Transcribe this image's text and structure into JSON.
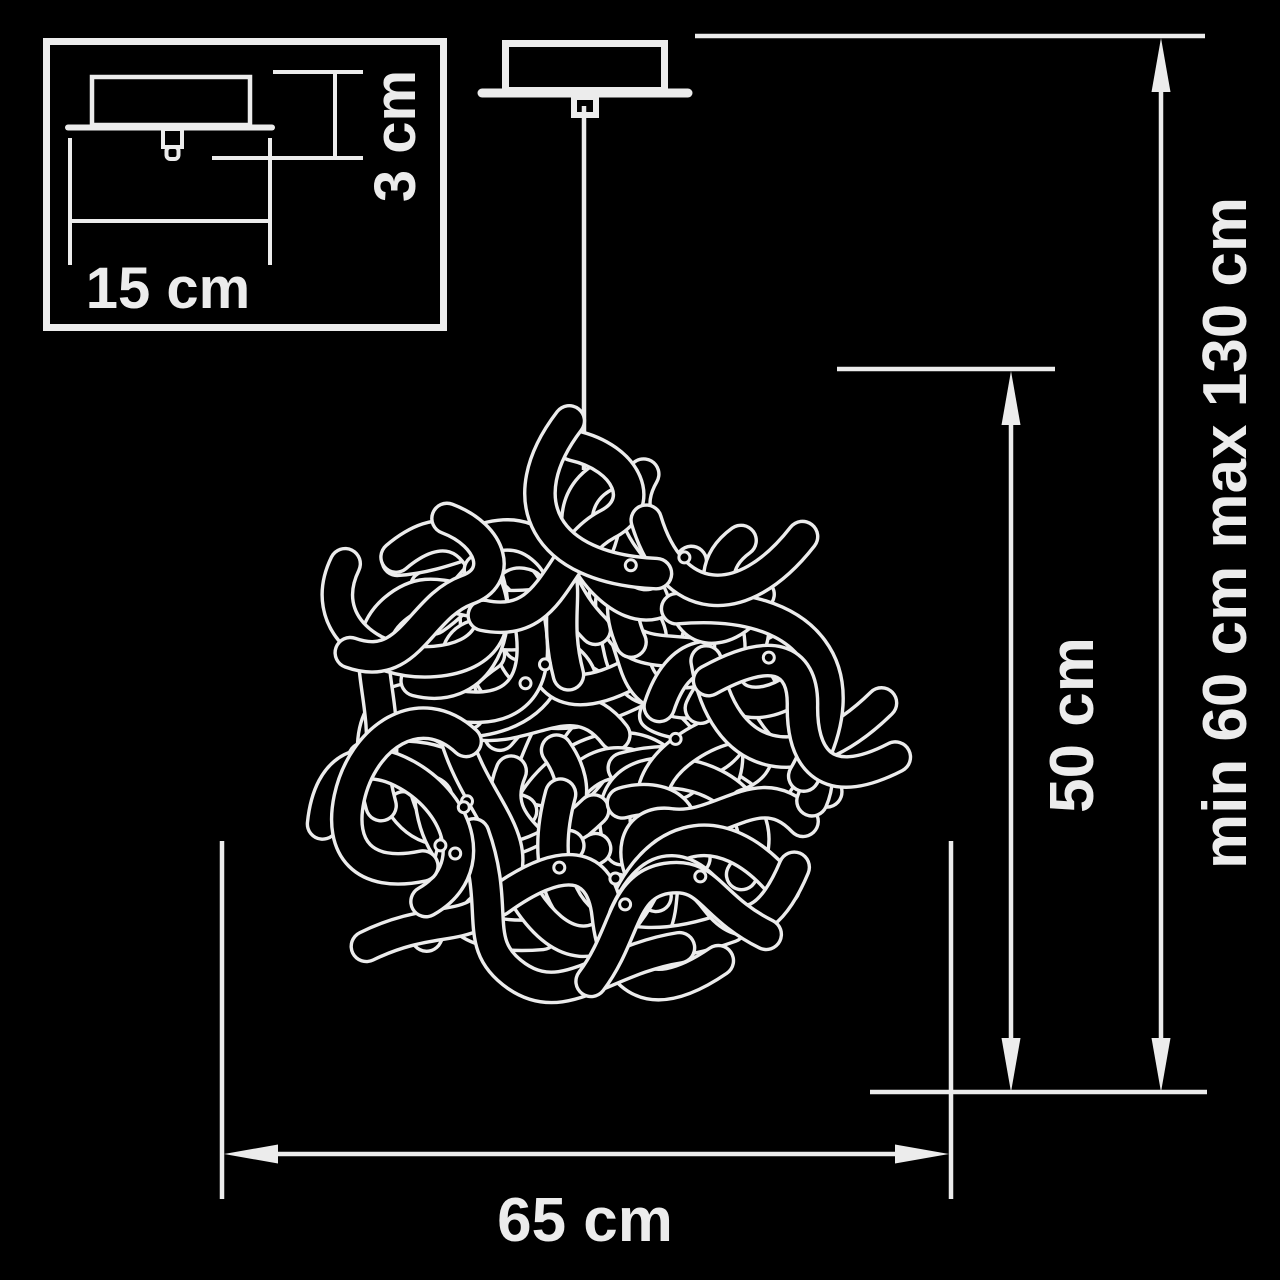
{
  "colors": {
    "background": "#000000",
    "line": "#ececec"
  },
  "labels": {
    "canopy_width": "15 cm",
    "canopy_height": "3 cm",
    "shade_height": "50 cm",
    "suspension_range": "min 60 cm max 130 cm",
    "shade_width": "65 cm"
  },
  "chandelier": {
    "cx": 591,
    "cy": 730,
    "spread": 220,
    "count": 58,
    "dots": 14,
    "seed": 11,
    "band": 27,
    "outline": 3.4,
    "scale_min": 0.72,
    "scale_max": 1.05,
    "color": "#ececec",
    "paths": [
      "M -118 12 C -68 -72 -22 -44 8 6 C 38 56 78 44 118 -28",
      "M -88 -72 C -120 -6 -58 44 14 38 C 72 33 98 -4 64 -66",
      "M -108 58 C -48 -64 46 -70 104 36",
      "M -112 -38 C -52 12 -62 54 -8 58 C 48 62 56 2 112 -44",
      "M -60 -105 C -95 -40 -20 -18 -8 40 C 0 85 50 80 78 30"
    ]
  }
}
